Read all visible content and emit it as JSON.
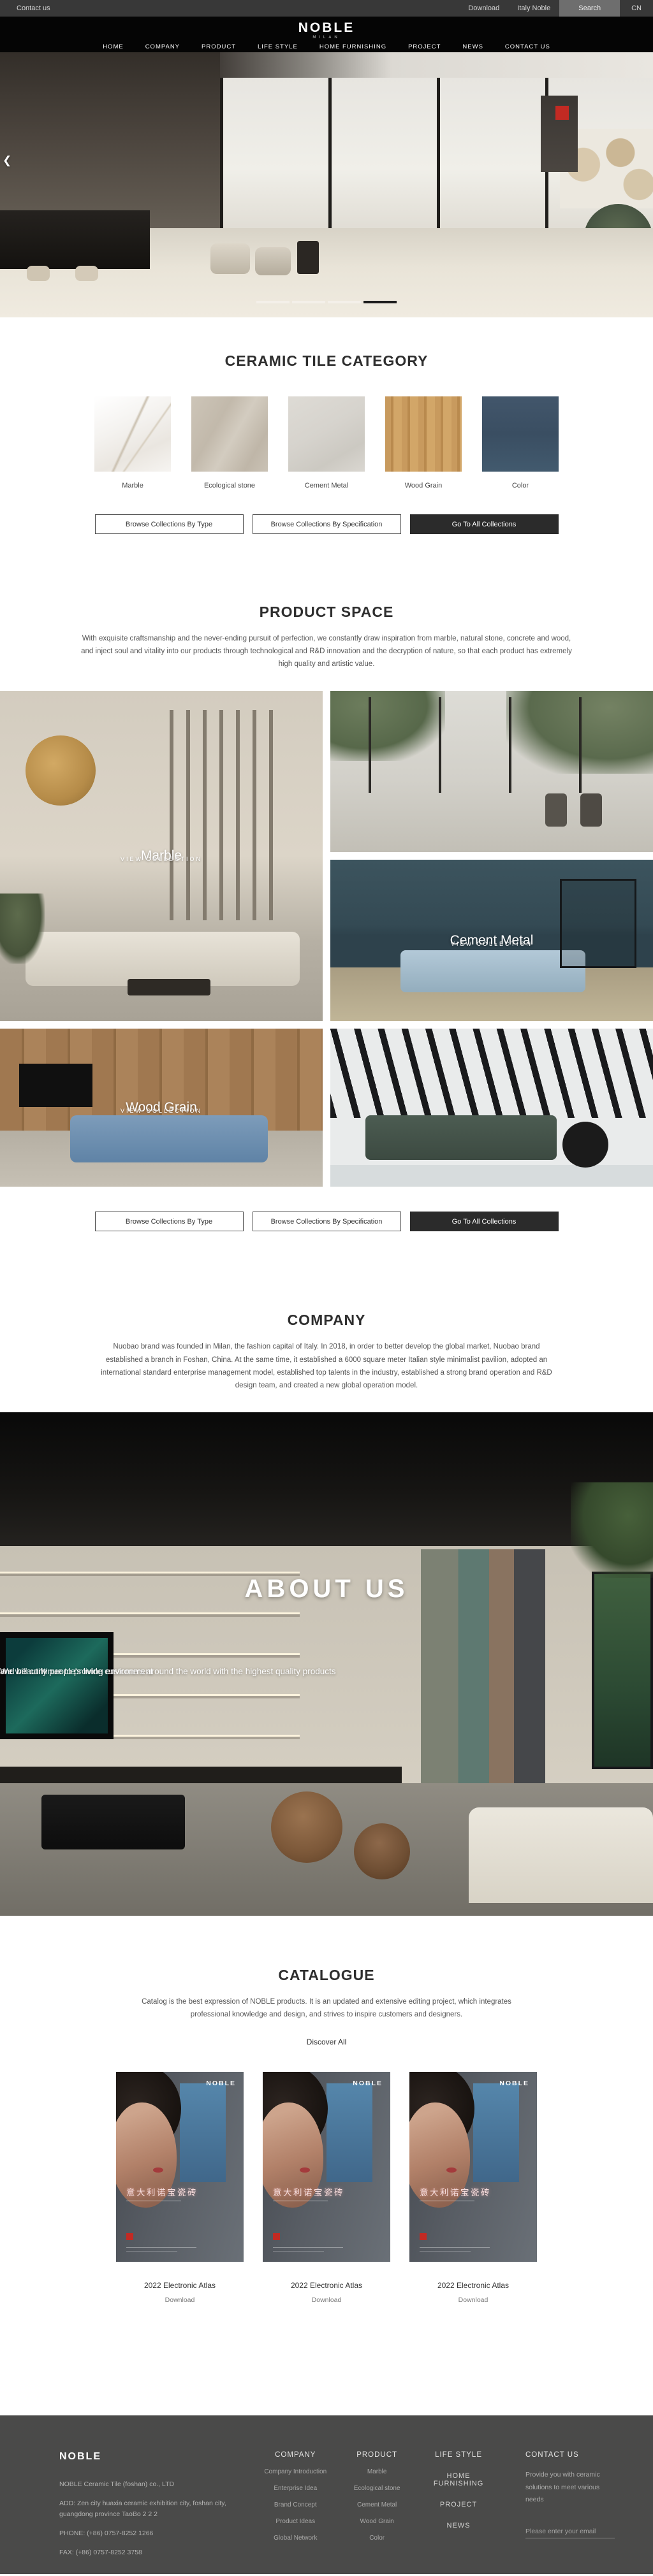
{
  "topbar": {
    "contact_us": "Contact us",
    "download": "Download",
    "italy_noble": "Italy Noble",
    "search": "Search",
    "language": "CN"
  },
  "header": {
    "logo": "NOBLE",
    "logo_subtitle": "MILAN",
    "nav": [
      "HOME",
      "COMPANY",
      "PRODUCT",
      "LIFE STYLE",
      "HOME FURNISHING",
      "PROJECT",
      "NEWS",
      "CONTACT US"
    ]
  },
  "hero": {
    "prev_arrow": "❮",
    "slide_count": 4,
    "active_slide": 4
  },
  "category": {
    "title": "CERAMIC TILE CATEGORY",
    "tiles": [
      {
        "label": "Marble"
      },
      {
        "label": "Ecological stone"
      },
      {
        "label": "Cement Metal"
      },
      {
        "label": "Wood Grain"
      },
      {
        "label": "Color"
      }
    ],
    "buttons": [
      {
        "label": "Browse Collections By Type"
      },
      {
        "label": "Browse Collections By Specification"
      },
      {
        "label": "Go To All Collections"
      }
    ]
  },
  "product_space": {
    "title": "PRODUCT SPACE",
    "description": "With exquisite craftsmanship and the never-ending pursuit of perfection, we constantly draw inspiration from marble, natural stone, concrete and wood, and inject soul and vitality into our products through technological and R&D innovation and the decryption of nature, so that each product has extremely high quality and artistic value.",
    "cards": [
      {
        "label": "Marble",
        "sublabel": "VIEW COLLECTION"
      },
      {
        "label": "Cement Metal",
        "sublabel": "VIEW COLLECTION"
      },
      {
        "label": "Wood Grain",
        "sublabel": "VIEW COLLECTION"
      }
    ]
  },
  "company": {
    "title": "COMPANY",
    "description": "Nuobao brand was founded in Milan, the fashion capital of Italy. In 2018, in order to better develop the global market, Nuobao brand established a branch in Foshan, China. At the same time, it established a 6000 square meter Italian style minimalist pavilion, adopted an international standard enterprise management model, established top talents in the industry, established a strong brand operation and R&D design team, and created a new global operation model."
  },
  "about": {
    "title": "ABOUT US",
    "line1": "We will continue to provide customers around the world with the highest quality products",
    "line2": "and beautify people's living environment"
  },
  "catalogue": {
    "title": "CATALOGUE",
    "description": "Catalog is the best expression of NOBLE products. It is an updated and extensive editing project, which integrates professional knowledge and design, and strives to inspire customers and designers.",
    "discover_all": "Discover All",
    "cards": [
      {
        "poster_brand": "NOBLE",
        "poster_title": "意大利诺宝瓷砖",
        "caption": "2022 Electronic Atlas",
        "download": "Download"
      },
      {
        "poster_brand": "NOBLE",
        "poster_title": "意大利诺宝瓷砖",
        "caption": "2022 Electronic Atlas",
        "download": "Download"
      },
      {
        "poster_brand": "NOBLE",
        "poster_title": "意大利诺宝瓷砖",
        "caption": "2022 Electronic Atlas",
        "download": "Download"
      }
    ]
  },
  "footer": {
    "brand": "NOBLE",
    "company_name": "NOBLE Ceramic Tile (foshan) co., LTD",
    "address": "ADD:  Zen city huaxia ceramic exhibition city, foshan city, guangdong province TaoBo 2 2 2",
    "phone": "PHONE:   (+86)  0757-8252 1266",
    "fax": "FAX:   (+86)  0757-8252 3758",
    "columns": [
      {
        "title": "COMPANY",
        "items": [
          "Company Introduction",
          "Enterprise Idea",
          "Brand Concept",
          "Product Ideas",
          "Global Network"
        ]
      },
      {
        "title": "PRODUCT",
        "items": [
          "Marble",
          "Ecological stone",
          "Cement Metal",
          "Wood Grain",
          "Color"
        ]
      },
      {
        "title": "LIFE STYLE",
        "items": [
          "HOME FURNISHING",
          "PROJECT",
          "NEWS"
        ]
      }
    ],
    "contact": {
      "title": "CONTACT US",
      "text": "Provide you with ceramic solutions to meet various needs",
      "email_placeholder": "Please enter your email"
    }
  },
  "colors": {
    "accent_red": "#c22a23",
    "dark_button": "#2b2b2b",
    "footer_background": "#4a4a49",
    "swatch_marble": "#f2f0ed",
    "swatch_ecological_stone": "#c9c1b4",
    "swatch_cement_metal": "#d9d6d0",
    "swatch_wood_grain": "#c79a62",
    "swatch_color": "#3d5166"
  }
}
